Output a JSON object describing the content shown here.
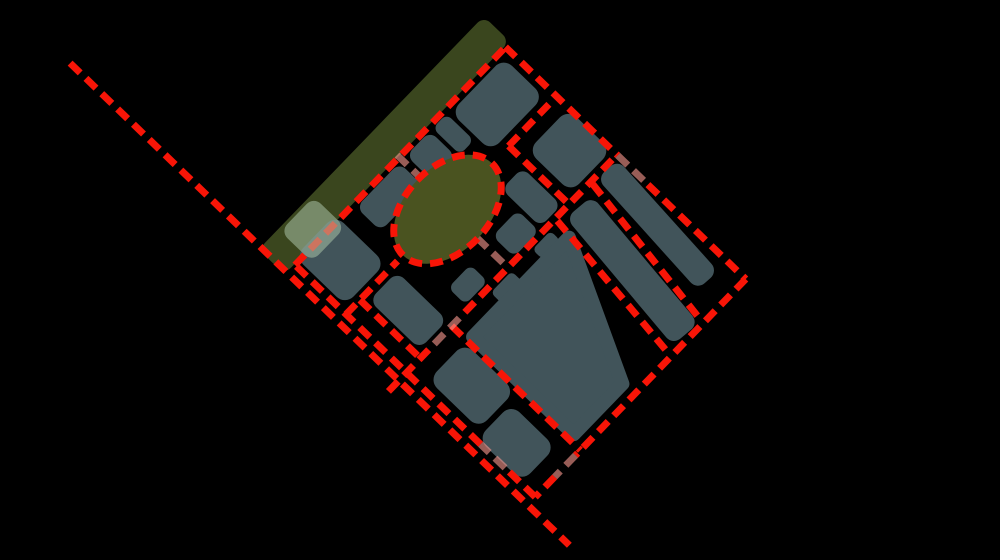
{
  "map": {
    "background": "#000000",
    "canvas": {
      "width": 1000,
      "height": 560
    },
    "colors": {
      "block": "#41545A",
      "park_strip": "#3A461E",
      "roundabout": "#4A5320",
      "road": "#F81507",
      "road_faded": "#F5968D",
      "highlight": "#AAC3A8"
    },
    "frame": {
      "origin_x": 295,
      "origin_y": 265,
      "rotate": -46,
      "width": 303,
      "height": 334
    },
    "road_style": {
      "width": 7,
      "dash": "14 8",
      "faded_opacity": 0.62,
      "faded_width": 7
    },
    "park_strip": {
      "x": -14,
      "y": -37,
      "w": 324,
      "h": 36,
      "rx": 9
    },
    "highlight_overlay": {
      "x": 14,
      "y": -34,
      "w": 48,
      "h": 44,
      "rx": 10,
      "opacity": 0.55
    },
    "roundabout": {
      "cx": 146,
      "cy": 71,
      "rx": 64,
      "ry": 42
    },
    "blocks": [
      {
        "x": 6,
        "y": -6,
        "w": 58,
        "h": 70,
        "rx": 12
      },
      {
        "x": 84,
        "y": 4,
        "w": 62,
        "h": 34,
        "rx": 9
      },
      {
        "x": 156,
        "y": 4,
        "w": 34,
        "h": 36,
        "rx": 9
      },
      {
        "x": 194,
        "y": 4,
        "w": 20,
        "h": 38,
        "rx": 7
      },
      {
        "x": 218,
        "y": 6,
        "w": 76,
        "h": 56,
        "rx": 12
      },
      {
        "x": 244,
        "y": 88,
        "w": 58,
        "h": 60,
        "rx": 12
      },
      {
        "x": 198,
        "y": 96,
        "w": 30,
        "h": 54,
        "rx": 9
      },
      {
        "x": 26,
        "y": 78,
        "w": 40,
        "h": 70,
        "rx": 10
      },
      {
        "x": 90,
        "y": 126,
        "w": 32,
        "h": 24,
        "rx": 7
      },
      {
        "x": 158,
        "y": 122,
        "w": 36,
        "h": 30,
        "rx": 8
      },
      {
        "x": 116,
        "y": 160,
        "w": 30,
        "h": 16,
        "rx": 5
      },
      {
        "x": 176,
        "y": 160,
        "w": 26,
        "h": 14,
        "rx": 5
      },
      {
        "x": 10,
        "y": 176,
        "w": 52,
        "h": 70,
        "rx": 12
      },
      {
        "x": 2,
        "y": 252,
        "w": 48,
        "h": 62,
        "rx": 12
      }
    ],
    "angled_blocks": [
      {
        "x": 222,
        "y": 164,
        "w": 34,
        "h": 166,
        "rotate": 6,
        "cx": 239,
        "cy": 164
      },
      {
        "x": 272,
        "y": 158,
        "w": 28,
        "h": 150,
        "rotate": 4,
        "cx": 286,
        "cy": 158
      }
    ],
    "polygon_blocks": [
      {
        "points": "72,178 210,178 142,318 72,318"
      }
    ],
    "roads_red": [
      [
        0,
        0,
        303,
        0
      ],
      [
        303,
        0,
        303,
        156
      ],
      [
        303,
        198,
        303,
        334
      ],
      [
        303,
        334,
        58,
        334
      ],
      [
        28,
        334,
        0,
        334
      ],
      [
        0,
        334,
        0,
        292
      ],
      [
        0,
        258,
        0,
        0
      ],
      [
        0,
        71,
        74,
        71
      ],
      [
        234,
        71,
        303,
        71
      ],
      [
        -26,
        155,
        40,
        155
      ],
      [
        84,
        155,
        303,
        155
      ],
      [
        20,
        71,
        20,
        155
      ],
      [
        234,
        71,
        234,
        158
      ],
      [
        65,
        155,
        65,
        334
      ],
      [
        214,
        158,
        196,
        330
      ],
      [
        265,
        158,
        242,
        332
      ],
      [
        -11,
        -302,
        -11,
        392
      ]
    ],
    "roads_faded": [
      [
        40,
        155,
        84,
        155
      ],
      [
        150,
        -3,
        150,
        30
      ],
      [
        146,
        112,
        146,
        152
      ],
      [
        303,
        156,
        303,
        198
      ],
      [
        58,
        334,
        28,
        334
      ],
      [
        0,
        292,
        0,
        258
      ]
    ]
  }
}
